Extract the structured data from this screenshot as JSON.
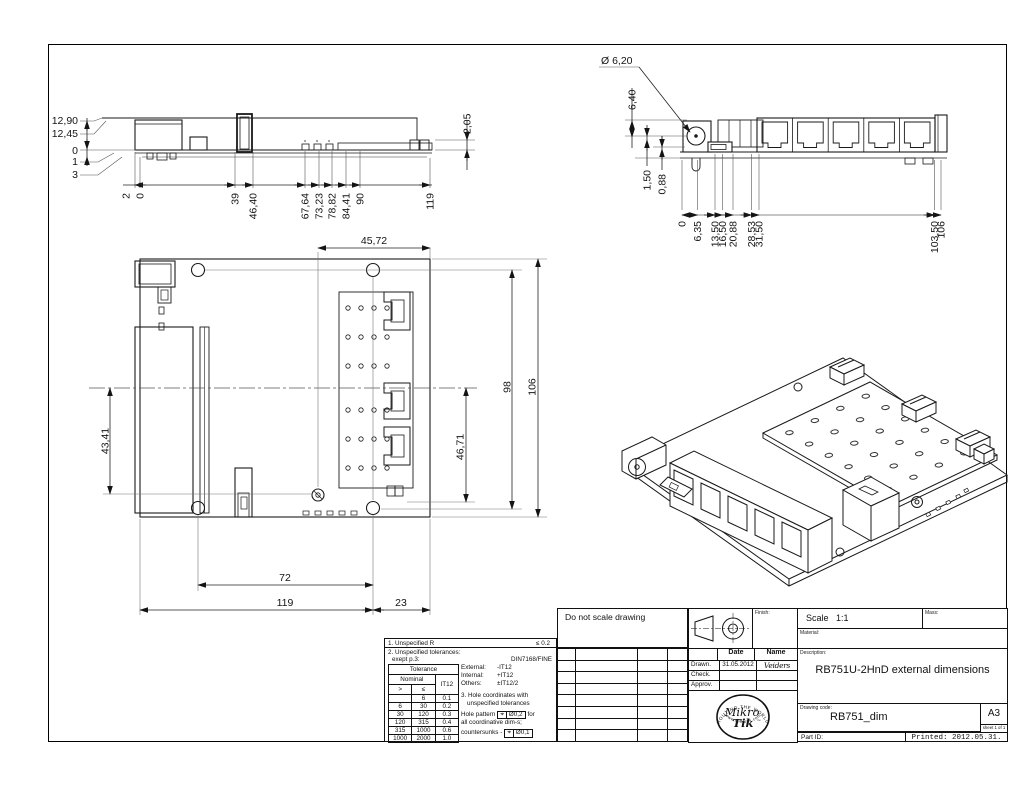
{
  "side_view": {
    "left_labels": [
      "12,90",
      "12,45",
      "0",
      "1",
      "3"
    ],
    "bottom_labels": [
      "2",
      "0",
      "39",
      "46,40",
      "67,64",
      "73,23",
      "78,82",
      "84,41",
      "90",
      "119"
    ],
    "right_label": "2,05"
  },
  "front_view": {
    "diameter_label": "Ø 6,20",
    "left_labels": [
      "6,40",
      "1,50",
      "0,88"
    ],
    "bottom_labels": [
      "0",
      "6,35",
      "13,50",
      "16,50",
      "20,88",
      "28,53",
      "31,50",
      "103,50",
      "106"
    ]
  },
  "plan_view": {
    "top_label": "45,72",
    "right_labels": [
      "98",
      "106"
    ],
    "left_label": "43,41",
    "inner_label": "46,71",
    "bottom_labels": [
      "72",
      "119",
      "23"
    ]
  },
  "notes": {
    "r_rule": "1. Unspecified R",
    "r_value": "≤  0.2",
    "tol_rule_1": "2. Unspecified tolerances:",
    "tol_rule_2": "exept p.3:",
    "tol_value": "DIN7168/FINE",
    "tol_table": {
      "title": "Tolerance",
      "nominal": "Nominal",
      "it12": "IT12",
      "gt": ">",
      "lte": "≤",
      "rows": [
        [
          "",
          "6",
          "0.1"
        ],
        [
          "6",
          "30",
          "0.2"
        ],
        [
          "30",
          "120",
          "0.3"
        ],
        [
          "120",
          "315",
          "0.4"
        ],
        [
          "315",
          "1000",
          "0.6"
        ],
        [
          "1000",
          "2000",
          "1.0"
        ]
      ]
    },
    "external_label": "External:",
    "external_value": "-IT12",
    "internal_label": "Internal:",
    "internal_value": "+IT12",
    "others_label": "Others:",
    "others_value": "±IT12/2",
    "hole_rule_1": "3. Hole coordinates with",
    "hole_rule_2": "unspecified tolerances",
    "hole_pattern_label": "Hole pattern",
    "position_symbol": "⌖",
    "hole_pattern_tol": "Ø0,2",
    "hole_pattern_suffix": "for",
    "coordinative": "all coordinative dim-s;",
    "countersunks_label": "countersunks -",
    "countersunk_tol": "Ø0,1"
  },
  "title_block": {
    "do_not_scale": "Do not scale drawing",
    "finish_label": "Finish:",
    "scale_label": "Scale",
    "scale_value": "1:1",
    "mass_label": "Mass:",
    "material_label": "Material:",
    "date_header": "Date",
    "name_header": "Name",
    "drawn_label": "Drawn.",
    "drawn_date": "31.05.2012",
    "drawn_name": "Veiders",
    "check_label": "Check.",
    "approv_label": "Approv.",
    "description_label": "Description:",
    "description": "RB751U-2HnD external dimensions",
    "drawing_code_label": "Drawing code:",
    "drawing_code": "RB751_dim",
    "paper_size": "A3",
    "sheet_label": "sheet 1 of 1",
    "part_id_label": "Part ID:",
    "printed_label": "Printed: 2012.05.31.",
    "logo": {
      "arc_top": "ROUTING THE WORLD",
      "name_top": "Mikro",
      "name_bottom": "Tik",
      "tm": "™",
      "arc_bottom": "www.mikrotik.com"
    }
  }
}
